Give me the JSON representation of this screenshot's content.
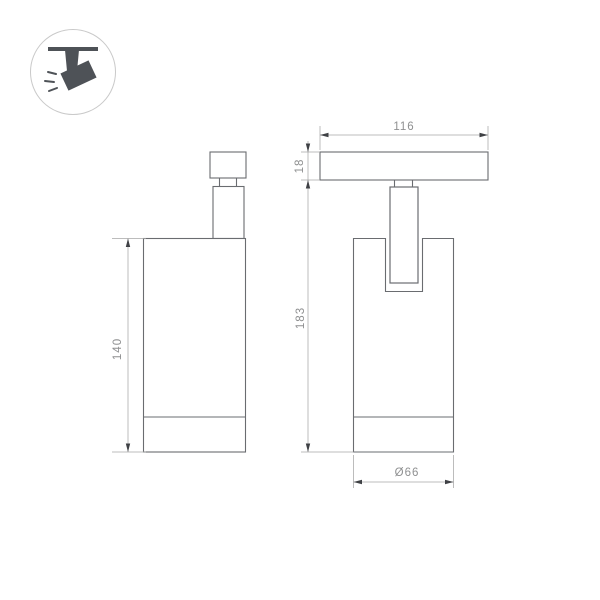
{
  "window": {
    "background": "#ffffff"
  },
  "legend_icon": {
    "name": "ceiling-track-spotlight",
    "shape_color": "#4e5257",
    "ring_color": "#c9c9c9"
  },
  "drawing": {
    "type": "technical-dimension-drawing",
    "views": [
      {
        "name": "front-view",
        "description": "cylindrical spotlight body with track connector on top"
      },
      {
        "name": "side-view",
        "description": "track adapter bar with fork arm entering slotted body"
      }
    ],
    "labels": {
      "track_length": "116",
      "track_thickness": "18",
      "overall_height": "183",
      "body_height": "140",
      "body_diameter": "Ø66"
    },
    "colors": {
      "outline": "#6a6c70",
      "dimension_line": "#a6a6a6",
      "arrow": "#3f4145",
      "label_text": "#8f9091"
    }
  }
}
